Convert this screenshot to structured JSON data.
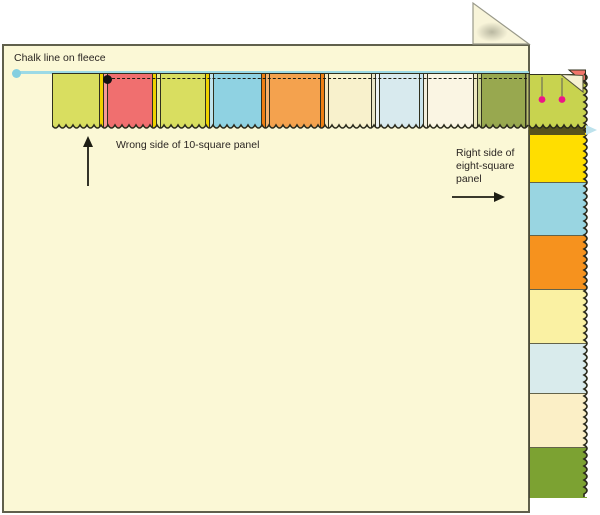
{
  "page": {
    "background": "#FFFFFF",
    "description": "Sewing diagram: square patchwork panels stitched to a fleece along a chalk line"
  },
  "labels": {
    "chalk_line": "Chalk line on fleece",
    "wrong_side": "Wrong side of 10-square panel",
    "right_side": "Right side of eight-square panel"
  },
  "colors": {
    "fleece": "#FBF8D6",
    "fleece_border": "#60604C",
    "outline": "#30301E",
    "chalk": "#9CDAE6",
    "chalk_dot": "#84CFE0",
    "stitch": "#1E1E14",
    "pin_head": "#EC1687",
    "pin_shaft": "#707058",
    "fold_red": "#F1766B",
    "fold_back": "#F6F1D2",
    "shadow_under_corner": "#56521C",
    "arrow_blue": "#BDE2EC",
    "text": "#2A2522",
    "fold_triangle_fill": "#F8F4D9",
    "fold_triangle_shadow": "#8F8F7B"
  },
  "fleece": {
    "fill": "#FBF8D6",
    "border": "#60604C",
    "top_right_corner_folded": true
  },
  "ten_square_panel": {
    "label": "10-square panel",
    "side_shown": "wrong side",
    "orientation": "horizontal",
    "squares": [
      {
        "name": "chartreuse",
        "color": "#D9DE60",
        "width": 47
      },
      {
        "name": "salmon",
        "color": "#F06F6F",
        "width": 44
      },
      {
        "name": "chartreuse",
        "color": "#D9DE60",
        "width": 44
      },
      {
        "name": "sky-blue",
        "color": "#8FD2E2",
        "width": 47
      },
      {
        "name": "orange",
        "color": "#F4A24E",
        "width": 50
      },
      {
        "name": "cream",
        "color": "#F8F1CC",
        "width": 42
      },
      {
        "name": "pale-blue",
        "color": "#D8EAEE",
        "width": 39
      },
      {
        "name": "ivory",
        "color": "#FAF5E3",
        "width": 45
      },
      {
        "name": "olive",
        "color": "#98A84F",
        "width": 47
      }
    ],
    "seams": [
      {
        "a": "#EFD200",
        "b": "#F59A98"
      },
      {
        "a": "#EFD200",
        "b": "#E9EC9E"
      },
      {
        "a": "#EFD200",
        "b": "#BFE3EC"
      },
      {
        "a": "#EE7F14",
        "b": "#F5B26E"
      },
      {
        "a": "#EE7F14",
        "b": "#F6E9C2"
      },
      {
        "a": "#E9E5C6",
        "b": "#EDF3F4"
      },
      {
        "a": "#C9E4EC",
        "b": "#F2EEDC"
      },
      {
        "a": "#EFE9C2",
        "b": "#C9D28F"
      }
    ]
  },
  "eight_square_panel": {
    "label": "eight-square panel",
    "side_shown": "right side",
    "orientation": "vertical",
    "squares": [
      {
        "name": "chartreuse-corner",
        "color": "#C8D34F",
        "height": 57
      },
      {
        "name": "yellow",
        "color": "#FFDE00",
        "height": 50
      },
      {
        "name": "sky-blue",
        "color": "#99D5E1",
        "height": 53
      },
      {
        "name": "orange",
        "color": "#F6921E",
        "height": 54
      },
      {
        "name": "pale-yellow",
        "color": "#FAF1A3",
        "height": 54
      },
      {
        "name": "pale-blue",
        "color": "#D9EBEC",
        "height": 50
      },
      {
        "name": "cream",
        "color": "#FBEFC6",
        "height": 54
      },
      {
        "name": "green",
        "color": "#7CA232",
        "height": 51
      }
    ]
  },
  "annotations": {
    "chalk_dot": true,
    "stitch_start_dot": true,
    "pin_count": 2,
    "corner_fold_shown": true
  }
}
